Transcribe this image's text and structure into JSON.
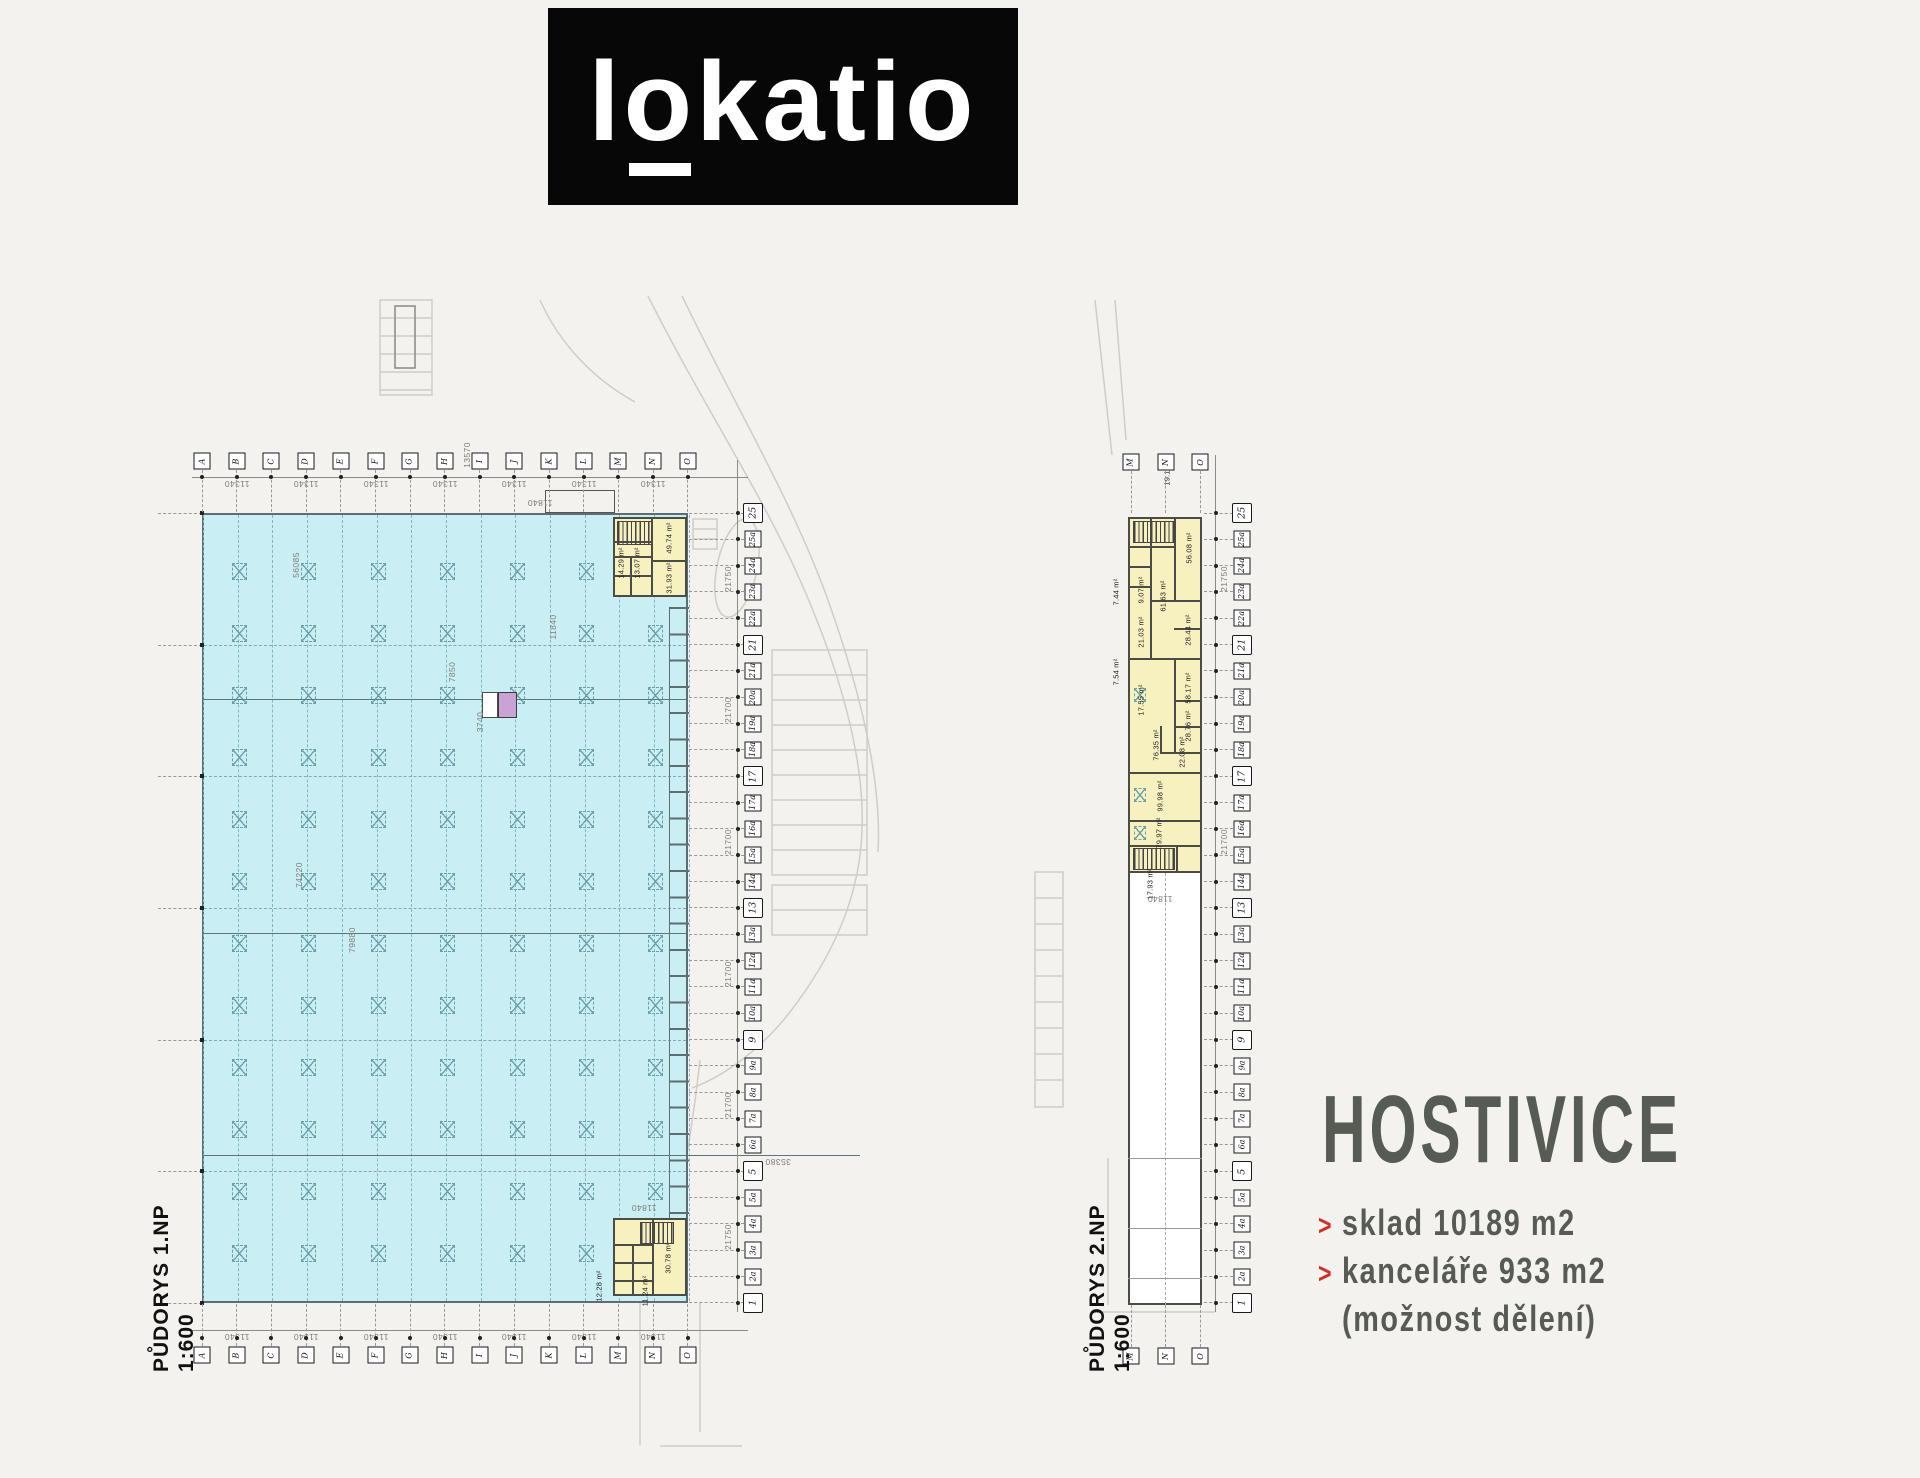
{
  "logo": {
    "pre": "l",
    "o": "o",
    "rest": "katio"
  },
  "project": {
    "title": "HOSTIVICE",
    "accent_color": "#d52f22",
    "text_color": "#565b53",
    "bullets": [
      {
        "marker": ">",
        "text": "sklad 10189 m2"
      },
      {
        "marker": ">",
        "text": "kanceláře 933 m2"
      },
      {
        "marker": "",
        "text": "(možnost dělení)"
      }
    ]
  },
  "colors": {
    "warehouse_fill": "#c9eef4",
    "office_fill": "#f6f1bf",
    "highlight_room": "#c9a3d4",
    "logo_bg": "#070707"
  },
  "plan1": {
    "title": "PŮDORYS 1.NP",
    "scale": "1:600",
    "col_labels": [
      "A",
      "B",
      "C",
      "D",
      "E",
      "F",
      "G",
      "H",
      "I",
      "J",
      "K",
      "L",
      "M",
      "N",
      "O"
    ],
    "row_labels": [
      "25",
      "25a",
      "24a",
      "23a",
      "22a",
      "21",
      "21a",
      "20a",
      "19a",
      "18a",
      "17",
      "17a",
      "16a",
      "15a",
      "14a",
      "13",
      "13a",
      "12a",
      "11a",
      "10a",
      "9",
      "9a",
      "8a",
      "7a",
      "6a",
      "5",
      "5a",
      "4a",
      "3a",
      "2a",
      "1"
    ],
    "col_dim": "11340",
    "row_dims": [
      "21750",
      "21700",
      "21700",
      "21700",
      "21700",
      "21750"
    ],
    "extra_dims": [
      "56085",
      "74220",
      "79880",
      "13570",
      "11840",
      "7850",
      "3740",
      "11840",
      "11840",
      "35380"
    ],
    "rooms": [
      "49.74 m²",
      "14.29 m²",
      "13.07 m²",
      "31.93 m²",
      "30.78 m²",
      "12.28 m²",
      "11.24 m²"
    ]
  },
  "plan2": {
    "title": "PŮDORYS 2.NP",
    "scale": "1:600",
    "col_labels": [
      "M",
      "N",
      "O"
    ],
    "extra_dims": [
      "11840"
    ],
    "rooms": [
      "19.19 m²",
      "56.08 m²",
      "61.63 m²",
      "9.07 m²",
      "7.44 m²",
      "21.03 m²",
      "28.44 m²",
      "58.17 m²",
      "7.54 m²",
      "17.55 m²",
      "28.76 m²",
      "22.08 m²",
      "76.35 m²",
      "99.98 m²",
      "79.97 m²",
      "17.93 m²"
    ]
  }
}
